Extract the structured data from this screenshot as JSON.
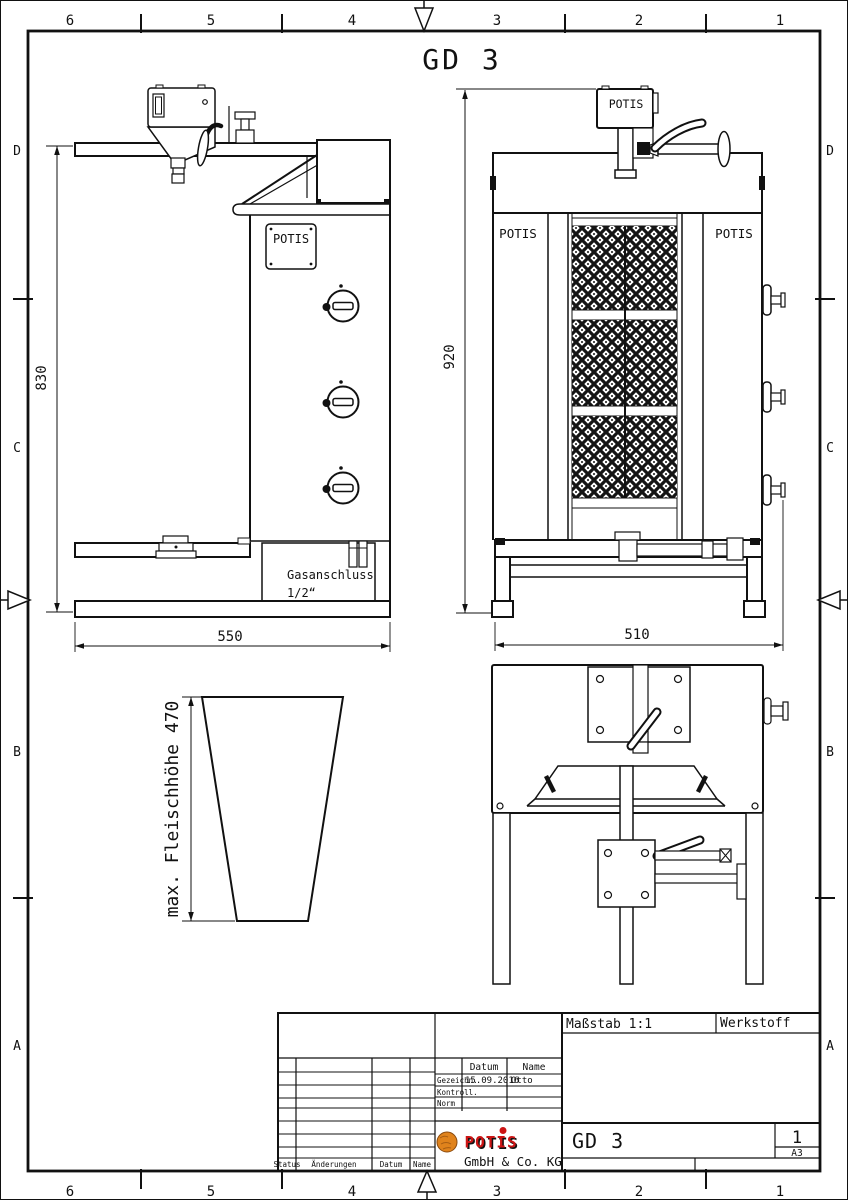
{
  "page": {
    "title": "GD 3"
  },
  "border": {
    "cols": [
      "6",
      "5",
      "4",
      "3",
      "2",
      "1"
    ],
    "rows": [
      "D",
      "C",
      "B",
      "A"
    ]
  },
  "side_view": {
    "height_dim": "830",
    "width_dim": "550",
    "plate_label": "POTIS",
    "gas_line1": "Gasanschluss",
    "gas_line2": "1/2“"
  },
  "front_view": {
    "height_dim": "920",
    "width_dim": "510",
    "motor_label": "POTIS",
    "left_panel_label": "POTIS",
    "right_panel_label": "POTIS"
  },
  "cone_view": {
    "dim_label": "max. Fleischhöhe 470"
  },
  "title_block": {
    "scale": "Maßstab 1:1",
    "material": "Werkstoff",
    "date_col": "Datum",
    "name_col": "Name",
    "drawn_row": "Gezeichn.",
    "drawn_date": "15.09.2016",
    "drawn_name": "Otto",
    "checked_row": "Kontroll.",
    "norm_row": "Norm",
    "status": "Status",
    "changes": "Änderungen",
    "date_label": "Datum",
    "name_label": "Name",
    "drawing_number": "GD 3",
    "sheet_number": "1",
    "paper_format": "A3",
    "logo_text": "POTIS",
    "company": "GmbH & Co. KG"
  },
  "colors": {
    "line": "#111111",
    "logo_red": "#cc1414",
    "logo_orange": "#e0831c"
  }
}
